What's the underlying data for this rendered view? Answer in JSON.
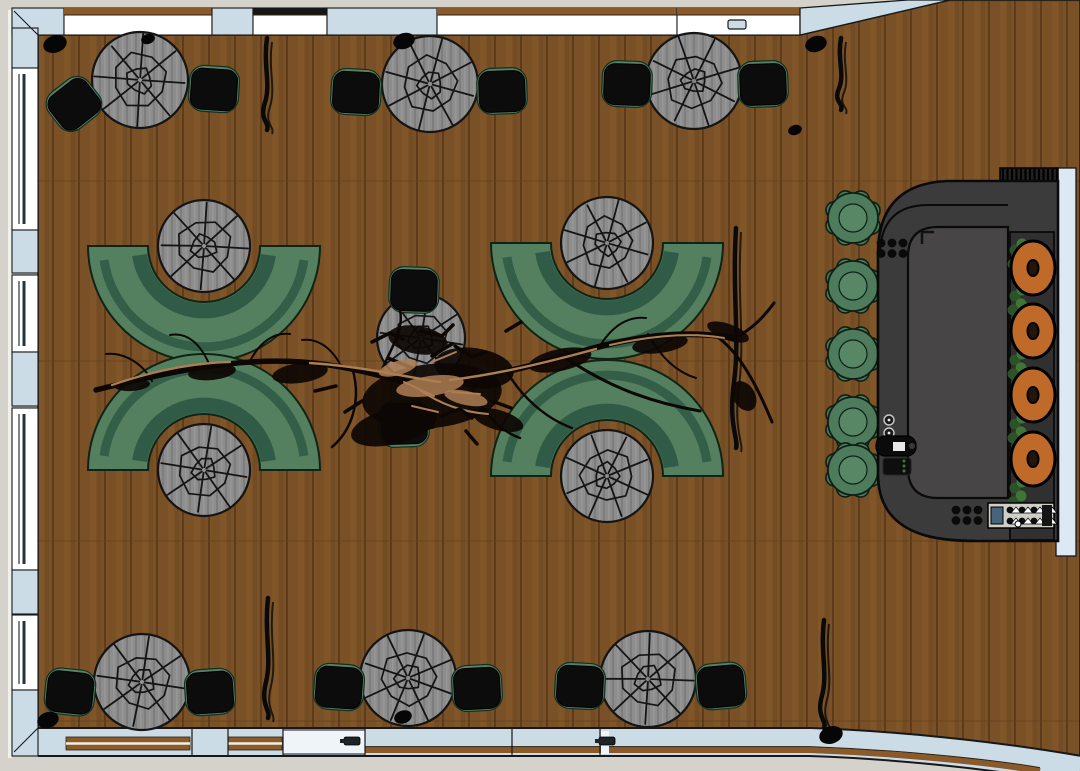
{
  "canvas": {
    "w": 1080,
    "h": 771
  },
  "palette": {
    "exterior": "#d4d2ca",
    "outer_sliver": "#f1f1ec",
    "wall_fill": "#ccdce7",
    "wall_stroke": "#16181a",
    "window_fill": "#ffffff",
    "window_mullion": "#25343c",
    "lintel_brown": "#8a5a2b",
    "lintel_dark": "#161616",
    "floor_base": "#7a5126",
    "floor_plank_dark": "#5e3c1b",
    "floor_plank_light": "#8b5f2f",
    "table_fill": "#8d8d8d",
    "table_fill2": "#7d7d7d",
    "table_stroke": "#141414",
    "chair_seat": "#0c0c0c",
    "chair_frame": "#55836a",
    "bench_main": "#54805f",
    "bench_dark": "#2e5844",
    "bench_outline": "#0f2417",
    "bar_fill": "#3b3b3b",
    "bar_inner": "#474545",
    "bar_stroke": "#0a0a0a",
    "hatch_bg": "#232323",
    "stool_fill": "#4d7b5c",
    "stool_inner": "#578765",
    "stool_stroke": "#0d2015",
    "donut_fill": "#bf6a28",
    "donut_hole": "#24150a",
    "panel_dark": "#303030",
    "plant_dark": "#2c5429",
    "plant_light": "#3f7a37",
    "branch_dark": "#0d0704",
    "branch_tan": "#ad7f53",
    "equip_panel": "#cfcfc8",
    "handle_dark": "#1d2327",
    "door_white": "#eef4f8"
  },
  "room": {
    "floor_path": "M38,35 L800,35 L950,0 L1080,0 L1080,758 C1000,742 900,731 810,728 L38,728 Z",
    "top_wall": {
      "y1": 8,
      "y2": 35,
      "segments": [
        {
          "type": "wall",
          "x1": 12,
          "x2": 64
        },
        {
          "type": "window",
          "x1": 64,
          "x2": 212,
          "lintel": "brown"
        },
        {
          "type": "wall",
          "x1": 212,
          "x2": 253
        },
        {
          "type": "window",
          "x1": 253,
          "x2": 327,
          "lintel": "dark"
        },
        {
          "type": "wall",
          "x1": 327,
          "x2": 437
        },
        {
          "type": "window",
          "x1": 437,
          "x2": 677,
          "lintel": "brown"
        },
        {
          "type": "window",
          "x1": 677,
          "x2": 800,
          "lintel": "brown"
        }
      ],
      "diagonal_band": "M800,8 L908,0 L950,0 L800,35 Z",
      "corner_wedge": "M800,0 L908,0 L800,8 Z",
      "door_handle": {
        "x": 728,
        "y": 20,
        "w": 18,
        "h": 9
      }
    },
    "left_wall": {
      "x1": 12,
      "x2": 38,
      "segments": [
        {
          "type": "wall",
          "y1": 28,
          "y2": 68
        },
        {
          "type": "window",
          "y1": 68,
          "y2": 230
        },
        {
          "type": "wall",
          "y1": 230,
          "y2": 273
        },
        {
          "type": "window",
          "y1": 275,
          "y2": 352
        },
        {
          "type": "wall",
          "y1": 352,
          "y2": 406
        },
        {
          "type": "window",
          "y1": 408,
          "y2": 570
        },
        {
          "type": "wall",
          "y1": 570,
          "y2": 614
        },
        {
          "type": "window",
          "y1": 615,
          "y2": 690
        },
        {
          "type": "wall",
          "y1": 690,
          "y2": 756
        }
      ]
    },
    "bottom_wall": {
      "band_path": "M38,742 L810,742 C900,745 1000,756 1080,770",
      "band_w": 26,
      "door": {
        "x1": 283,
        "x2": 365
      },
      "white_sep": {
        "x": 601,
        "y": 731,
        "w": 8,
        "h": 23
      },
      "stripes_center": [
        [
          66,
          190
        ],
        [
          228,
          282
        ]
      ],
      "stripe_low": "M365,750 L810,750 C890,753 980,761 1040,771",
      "dividers": [
        192,
        228,
        283,
        365,
        512,
        600
      ],
      "handles": [
        [
          344,
          737
        ],
        [
          599,
          737
        ]
      ]
    },
    "right_strip": {
      "x": 1056,
      "y": 168,
      "w": 20,
      "h": 388
    },
    "miters": [
      [
        38,
        35,
        14,
        11
      ],
      [
        38,
        728,
        14,
        752
      ]
    ]
  },
  "furniture": {
    "dining_table_radius": 48,
    "dining_tables": [
      {
        "x": 140,
        "y": 80
      },
      {
        "x": 430,
        "y": 84
      },
      {
        "x": 694,
        "y": 81
      },
      {
        "x": 142,
        "y": 682
      },
      {
        "x": 408,
        "y": 678
      },
      {
        "x": 648,
        "y": 679
      }
    ],
    "chairs": [
      {
        "x": 74,
        "y": 104,
        "rot": -38
      },
      {
        "x": 214,
        "y": 89,
        "rot": 4
      },
      {
        "x": 356,
        "y": 92,
        "rot": 3
      },
      {
        "x": 502,
        "y": 91,
        "rot": -2
      },
      {
        "x": 627,
        "y": 84,
        "rot": 2
      },
      {
        "x": 763,
        "y": 84,
        "rot": -2
      },
      {
        "x": 70,
        "y": 692,
        "rot": 6
      },
      {
        "x": 210,
        "y": 692,
        "rot": -4
      },
      {
        "x": 339,
        "y": 687,
        "rot": 4
      },
      {
        "x": 477,
        "y": 688,
        "rot": -3
      },
      {
        "x": 580,
        "y": 686,
        "rot": 3
      },
      {
        "x": 721,
        "y": 686,
        "rot": -5
      },
      {
        "x": 414,
        "y": 290,
        "rot": 2
      },
      {
        "x": 404,
        "y": 424,
        "rot": 178
      }
    ],
    "booths": [
      {
        "cx": 204,
        "cy": 246,
        "side": "south"
      },
      {
        "cx": 204,
        "cy": 470,
        "side": "north"
      },
      {
        "cx": 607,
        "cy": 243,
        "side": "south"
      },
      {
        "cx": 607,
        "cy": 476,
        "side": "north"
      }
    ],
    "booth_geom": {
      "outer_r": 116,
      "inner_r": 56,
      "table_r": 46
    },
    "center_table": {
      "x": 421,
      "y": 338,
      "r": 44
    },
    "bar": {
      "outline": "M1058,181 L947,181 Q879,184 878,252 L878,474 Q878,518 918,533 Q938,541 978,541 L1058,541 Z",
      "inner": "M1008,227 L938,227 Q908,227 908,257 L908,468 Q908,498 938,498 L1008,498 Z",
      "ledge": "M880,252 Q882,205 928,205 L1008,205",
      "hatch": {
        "x": 1000,
        "y": 168,
        "w": 58,
        "h": 46
      },
      "ovals_panel": {
        "x": 1010,
        "y": 232,
        "w": 44,
        "h": 308
      },
      "donut_cx": 1033,
      "donut_cys": [
        268,
        331,
        395,
        459
      ],
      "plants_y": [
        250,
        296,
        360,
        424,
        488
      ],
      "equip_panel": {
        "x": 988,
        "y": 503,
        "w": 66,
        "h": 25
      },
      "dot_clusters": [
        {
          "x": 881,
          "y": 243
        },
        {
          "x": 956,
          "y": 510
        }
      ],
      "knobs": [
        [
          889,
          420
        ],
        [
          889,
          433
        ]
      ],
      "corner_tick": [
        922,
        232
      ]
    },
    "stools": {
      "cx": 853,
      "cys": [
        218,
        286,
        354,
        422,
        470
      ],
      "r": 25
    }
  },
  "decor": {
    "plant_shadows": [
      {
        "x": 267,
        "y1": 38,
        "y2": 130
      },
      {
        "x": 841,
        "y1": 38,
        "y2": 110
      },
      {
        "x": 736,
        "y1": 228,
        "y2": 448
      },
      {
        "x": 268,
        "y1": 598,
        "y2": 718
      },
      {
        "x": 824,
        "y1": 620,
        "y2": 728
      }
    ],
    "blobs": [
      [
        55,
        44,
        12
      ],
      [
        404,
        41,
        11
      ],
      [
        816,
        44,
        11
      ],
      [
        148,
        39,
        7
      ],
      [
        48,
        720,
        11
      ],
      [
        403,
        717,
        9
      ],
      [
        831,
        735,
        12
      ],
      [
        795,
        130,
        7
      ]
    ],
    "tree": {
      "branches": [
        {
          "d": "M96,390 C160,374 232,357 302,362 C352,366 382,377 418,385",
          "w": 5.5
        },
        {
          "d": "M418,385 C472,381 522,369 576,353 C630,337 682,329 734,338",
          "w": 6
        },
        {
          "d": "M734,338 C752,330 766,314 774,303",
          "w": 3
        },
        {
          "d": "M716,336 C740,352 758,388 772,422",
          "w": 3
        },
        {
          "d": "M560,354 C600,382 642,401 700,411",
          "w": 3
        },
        {
          "d": "M505,368 C520,396 545,418 572,428",
          "w": 2.5
        },
        {
          "d": "M470,382 C480,410 498,430 520,438",
          "w": 2.5
        },
        {
          "d": "M352,367 C362,400 352,430 332,447",
          "w": 2.5
        },
        {
          "d": "M380,374 C392,346 404,330 400,310",
          "w": 2.5
        },
        {
          "d": "M340,364 C330,346 316,338 302,340",
          "w": 2
        },
        {
          "d": "M210,366 C200,342 186,332 170,335",
          "w": 2
        },
        {
          "d": "M152,381 C142,362 122,352 106,354",
          "w": 2
        },
        {
          "d": "M250,361 C260,342 274,332 290,334",
          "w": 2
        },
        {
          "d": "M600,346 C612,326 628,316 646,318",
          "w": 2
        },
        {
          "d": "M648,334 C660,356 676,372 696,378",
          "w": 2
        },
        {
          "d": "M112,385 C150,372 190,363 230,362",
          "w": 2.2,
          "c": "tan"
        },
        {
          "d": "M310,363 C360,366 400,376 440,382",
          "w": 2.4,
          "c": "tan"
        },
        {
          "d": "M450,380 C500,374 548,362 596,349",
          "w": 2.4,
          "c": "tan"
        },
        {
          "d": "M610,345 C650,336 690,332 724,338",
          "w": 2,
          "c": "tan"
        },
        {
          "d": "M420,390 C440,404 462,412 488,414",
          "w": 2,
          "c": "tan"
        }
      ],
      "scribbles": [
        "M372,342 l18,-9 l13,6",
        "M420,331 l22,5 l11,-11",
        "M455,346 l17,11 l14,-5",
        "M396,421 l21,9 l16,-3",
        "M441,416 l19,-7 l12,9",
        "M362,401 l-17,11",
        "M492,401 l19,7",
        "M506,331 l15,-9",
        "M336,386 l-21,5",
        "M466,431 l11,13",
        "M388,358 l24,10",
        "M432,356 l20,-12"
      ],
      "tan_scribbles": [
        "M404,382 l30,14",
        "M432,362 l24,-10",
        "M412,406 l26,6",
        "M452,392 l28,2"
      ],
      "mass": [
        [
          432,
          396,
          70,
          32,
          -6
        ],
        [
          474,
          368,
          40,
          20,
          8
        ],
        [
          394,
          426,
          44,
          18,
          -14
        ],
        [
          300,
          373,
          28,
          10,
          -8
        ],
        [
          560,
          360,
          32,
          11,
          -12
        ],
        [
          660,
          344,
          28,
          9,
          -8
        ],
        [
          212,
          372,
          24,
          8,
          -6
        ],
        [
          132,
          385,
          18,
          6,
          -4
        ],
        [
          728,
          332,
          22,
          8,
          20
        ],
        [
          744,
          396,
          16,
          11,
          60
        ],
        [
          418,
          340,
          30,
          14,
          10
        ],
        [
          498,
          420,
          26,
          10,
          16
        ]
      ],
      "tan_mass": [
        [
          430,
          386,
          34,
          10,
          -8
        ],
        [
          466,
          398,
          22,
          7,
          12
        ],
        [
          398,
          368,
          20,
          7,
          -16
        ]
      ]
    }
  }
}
